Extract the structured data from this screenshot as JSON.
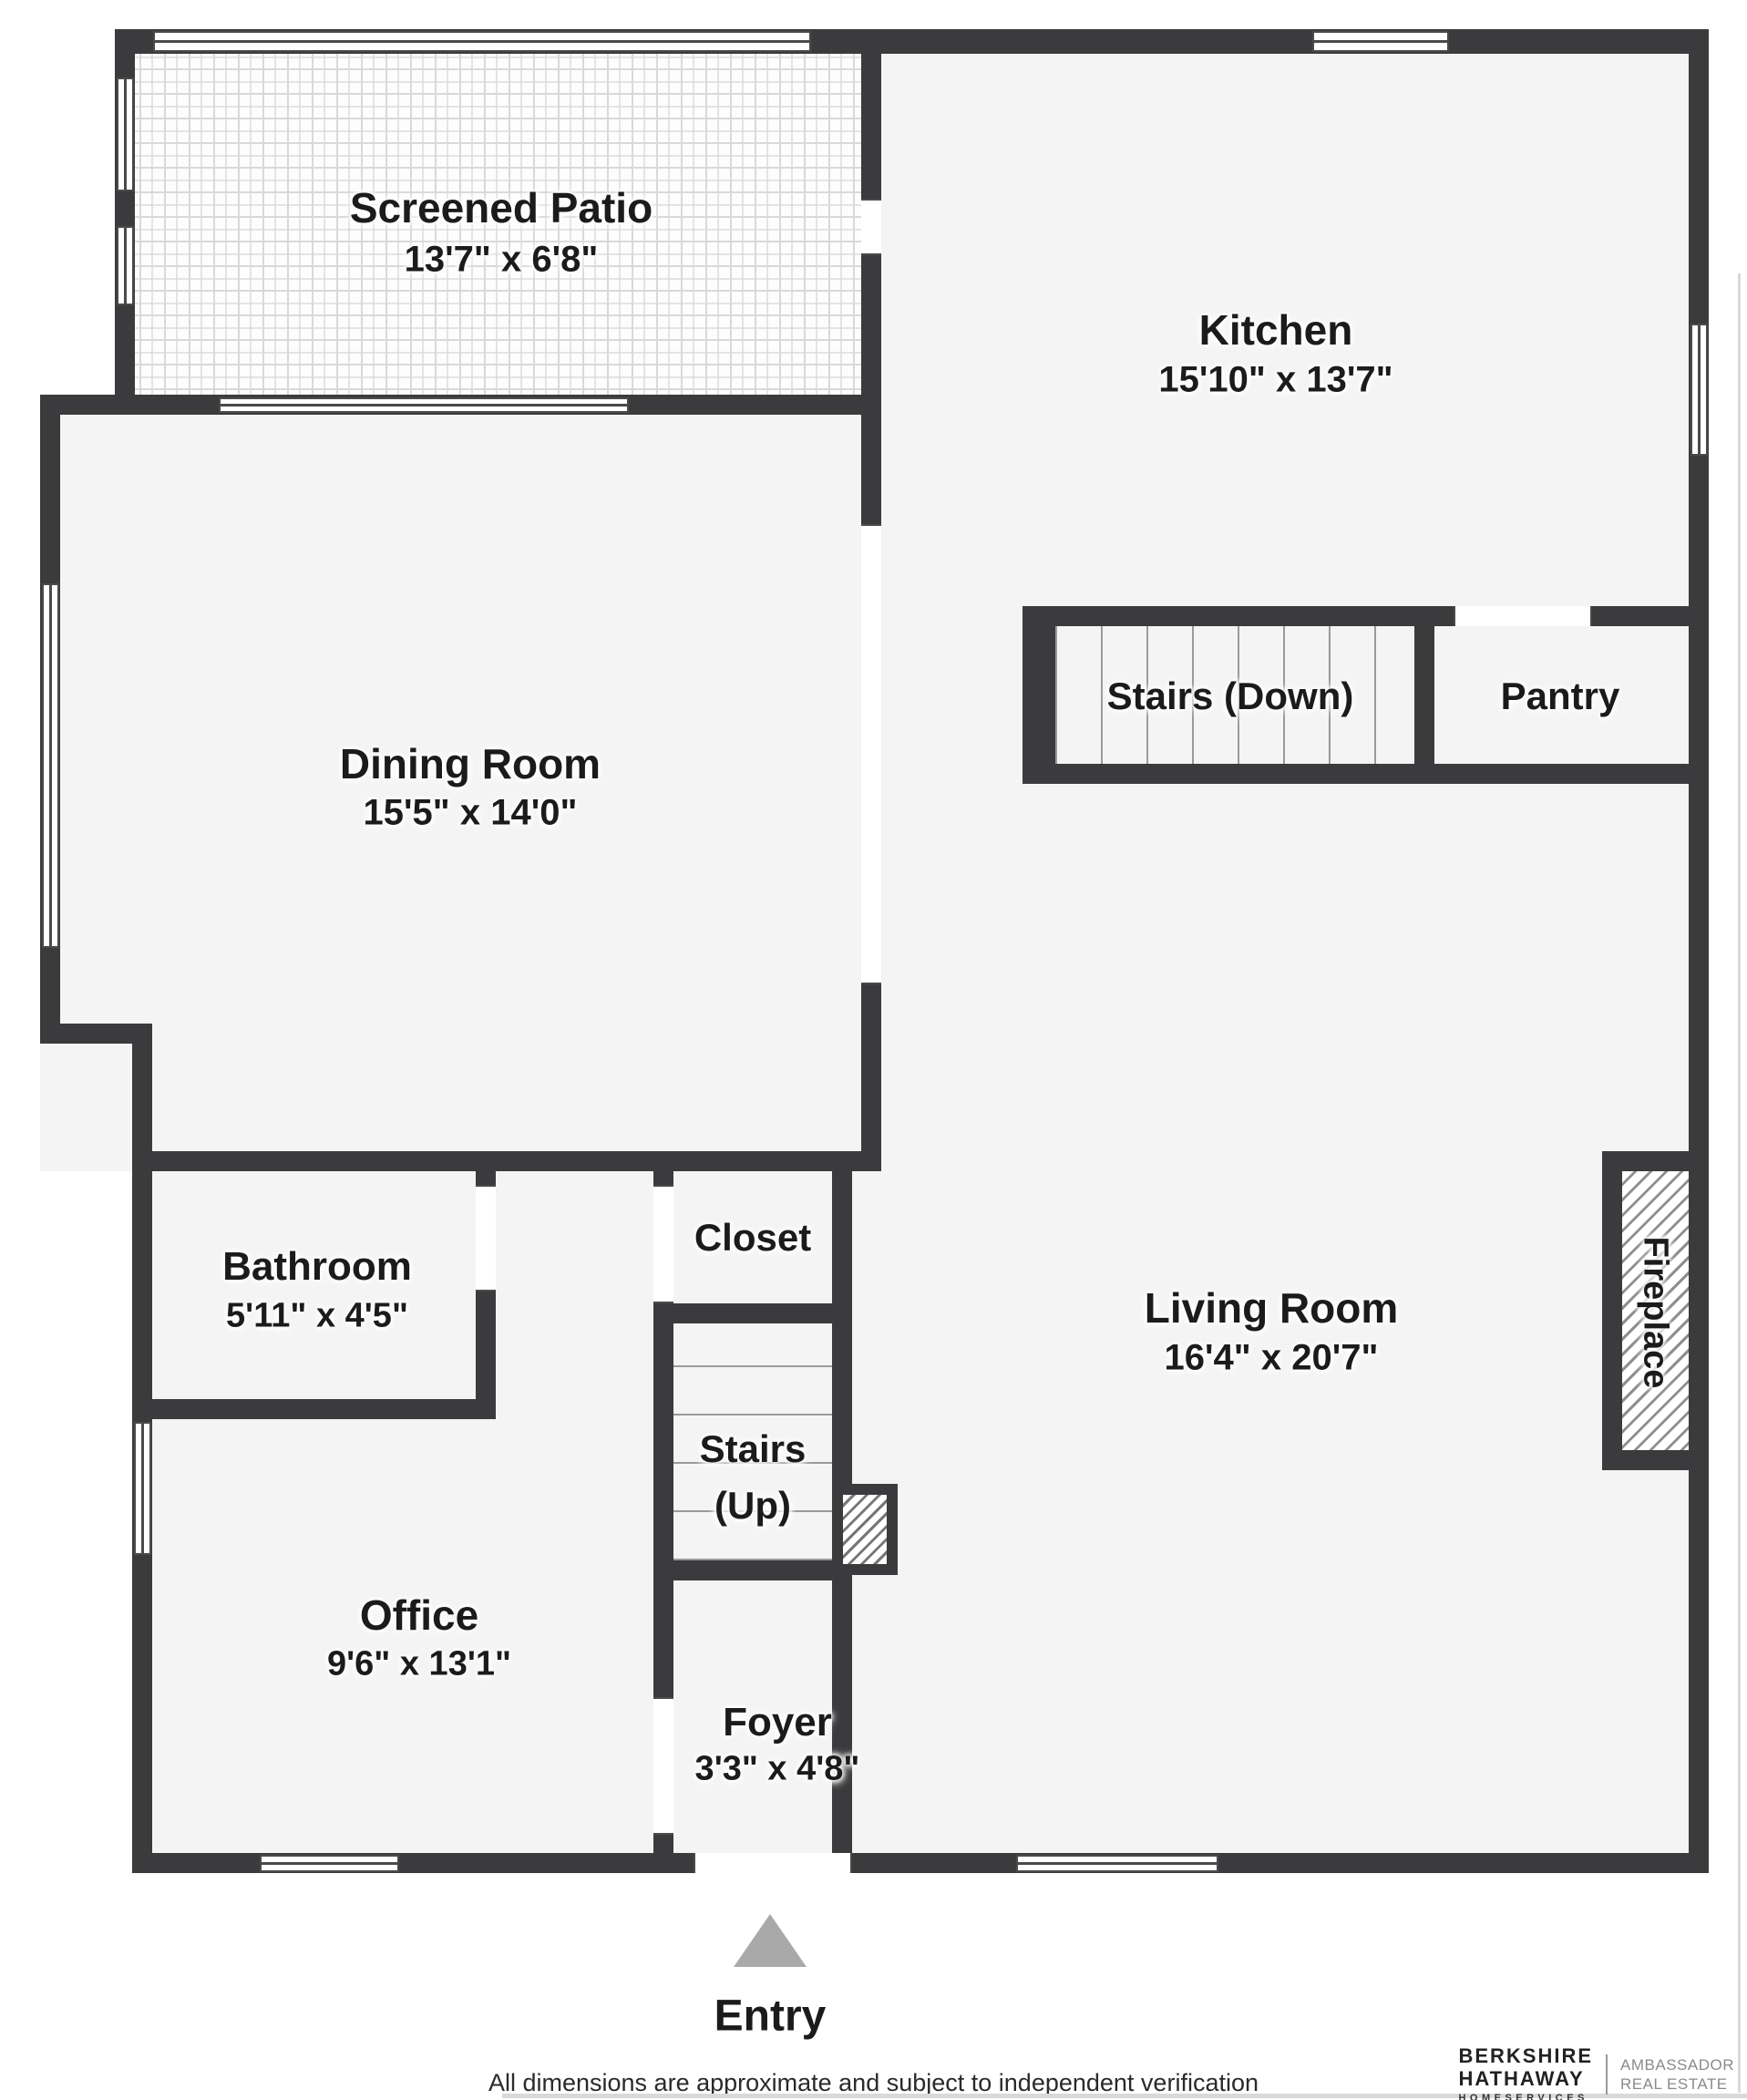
{
  "rooms": {
    "patio": {
      "name": "Screened Patio",
      "dims": "13'7\" x 6'8\""
    },
    "kitchen": {
      "name": "Kitchen",
      "dims": "15'10\" x 13'7\""
    },
    "stairs_down": {
      "name": "Stairs (Down)"
    },
    "pantry": {
      "name": "Pantry"
    },
    "dining": {
      "name": "Dining Room",
      "dims": "15'5\" x 14'0\""
    },
    "bathroom": {
      "name": "Bathroom",
      "dims": "5'11\" x 4'5\""
    },
    "closet": {
      "name": "Closet"
    },
    "living": {
      "name": "Living Room",
      "dims": "16'4\" x 20'7\""
    },
    "stairs_up": {
      "name": "Stairs",
      "name2": "(Up)"
    },
    "office": {
      "name": "Office",
      "dims": "9'6\" x 13'1\""
    },
    "foyer": {
      "name": "Foyer",
      "dims": "3'3\" x 4'8\""
    },
    "fireplace": {
      "name": "Fireplace"
    }
  },
  "entry": {
    "label": "Entry"
  },
  "footer": {
    "disclaimer": "All dimensions are approximate and subject to independent verification"
  },
  "brand": {
    "name_line1": "BERKSHIRE",
    "name_line2": "HATHAWAY",
    "name_line3": "HOMESERVICES",
    "division_line1": "AMBASSADOR",
    "division_line2": "REAL ESTATE"
  },
  "colors": {
    "wall": "#3b3b3d",
    "floor": "#f4f4f4",
    "label": "#1b1b1b",
    "entry_arrow": "#a9a9a9"
  }
}
